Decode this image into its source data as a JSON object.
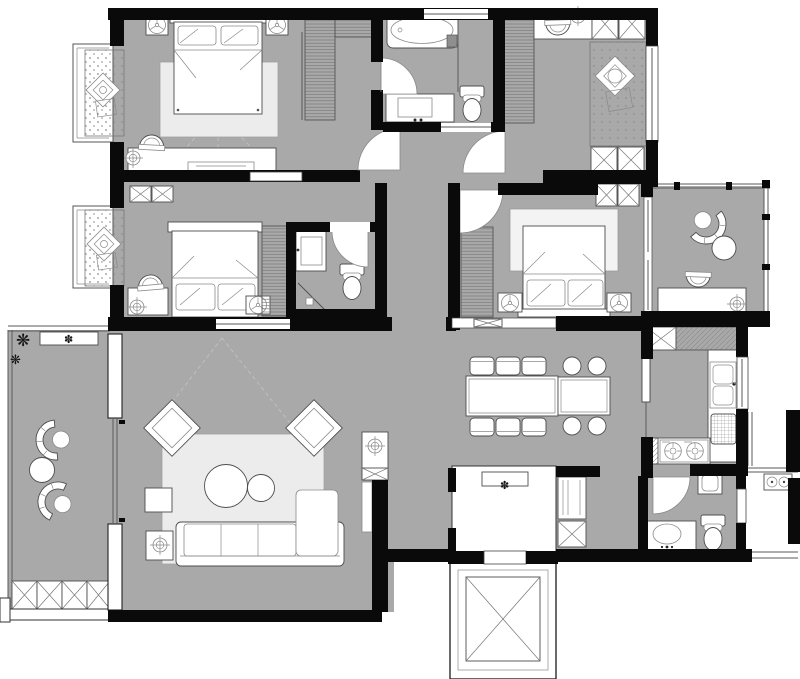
{
  "plan": {
    "kind": "apartment-floor-plan",
    "palette": {
      "floor": "#a9a9a9",
      "wall": "#0a0a0a",
      "line": "#4d4d4d",
      "soft": "#8a8a8a",
      "rug": "#ececec",
      "glassln": "#5a5a5a",
      "dash": "#c2c2c2",
      "paper": "#ffffff"
    },
    "icons": {
      "plant": "❋",
      "flower": "✽"
    },
    "rooms": [
      {
        "name": "master-bedroom",
        "furniture": [
          "double-bed",
          "nightstand-lamps",
          "wardrobe-l",
          "dresser",
          "stool",
          "rug",
          "bay-window-seat"
        ]
      },
      {
        "name": "bedroom-2",
        "furniture": [
          "double-bed",
          "desk",
          "chair",
          "wardrobe",
          "bay-window-seat",
          "ac-cabinets"
        ]
      },
      {
        "name": "ensuite-bathroom",
        "furniture": [
          "washbasin",
          "toilet",
          "shower-corner"
        ]
      },
      {
        "name": "main-bathroom",
        "furniture": [
          "bathtub",
          "shower-area",
          "vanity",
          "toilet"
        ]
      },
      {
        "name": "tatami-study",
        "furniture": [
          "desk",
          "chair",
          "wardrobe",
          "tatami-mat",
          "tea-table",
          "storage-cabinets"
        ]
      },
      {
        "name": "bedroom-3",
        "furniture": [
          "double-bed",
          "nightstand-lamps",
          "wardrobe",
          "storage-cabinet",
          "rug"
        ]
      },
      {
        "name": "study-balcony",
        "furniture": [
          "shell-armchair",
          "round-side-table",
          "desk",
          "chair"
        ]
      },
      {
        "name": "living-room",
        "furniture": [
          "sofa",
          "chaise",
          "round-coffee-tables",
          "accent-chairs",
          "rug",
          "tv-cabinet",
          "side-tables"
        ]
      },
      {
        "name": "leisure-balcony",
        "furniture": [
          "shell-chairs",
          "round-table",
          "planter-boxes",
          "plants",
          "flower-shelf"
        ]
      },
      {
        "name": "dining-room",
        "furniture": [
          "dining-table",
          "six-chairs",
          "island-table",
          "four-round-stools"
        ]
      },
      {
        "name": "kitchen",
        "furniture": [
          "l-shaped-counter",
          "double-sink",
          "two-burner-cooktop",
          "drainer-rack"
        ]
      },
      {
        "name": "guest-bathroom",
        "furniture": [
          "vanity-oval-basin",
          "toilet",
          "small-washbasin"
        ]
      },
      {
        "name": "entry-foyer",
        "furniture": [
          "shoe-bench",
          "tall-cabinet",
          "storage-box"
        ]
      },
      {
        "name": "elevator-shaft",
        "furniture": [
          "elevator-car"
        ]
      },
      {
        "name": "utility-balcony",
        "furniture": [
          "washer-connection"
        ]
      }
    ]
  }
}
